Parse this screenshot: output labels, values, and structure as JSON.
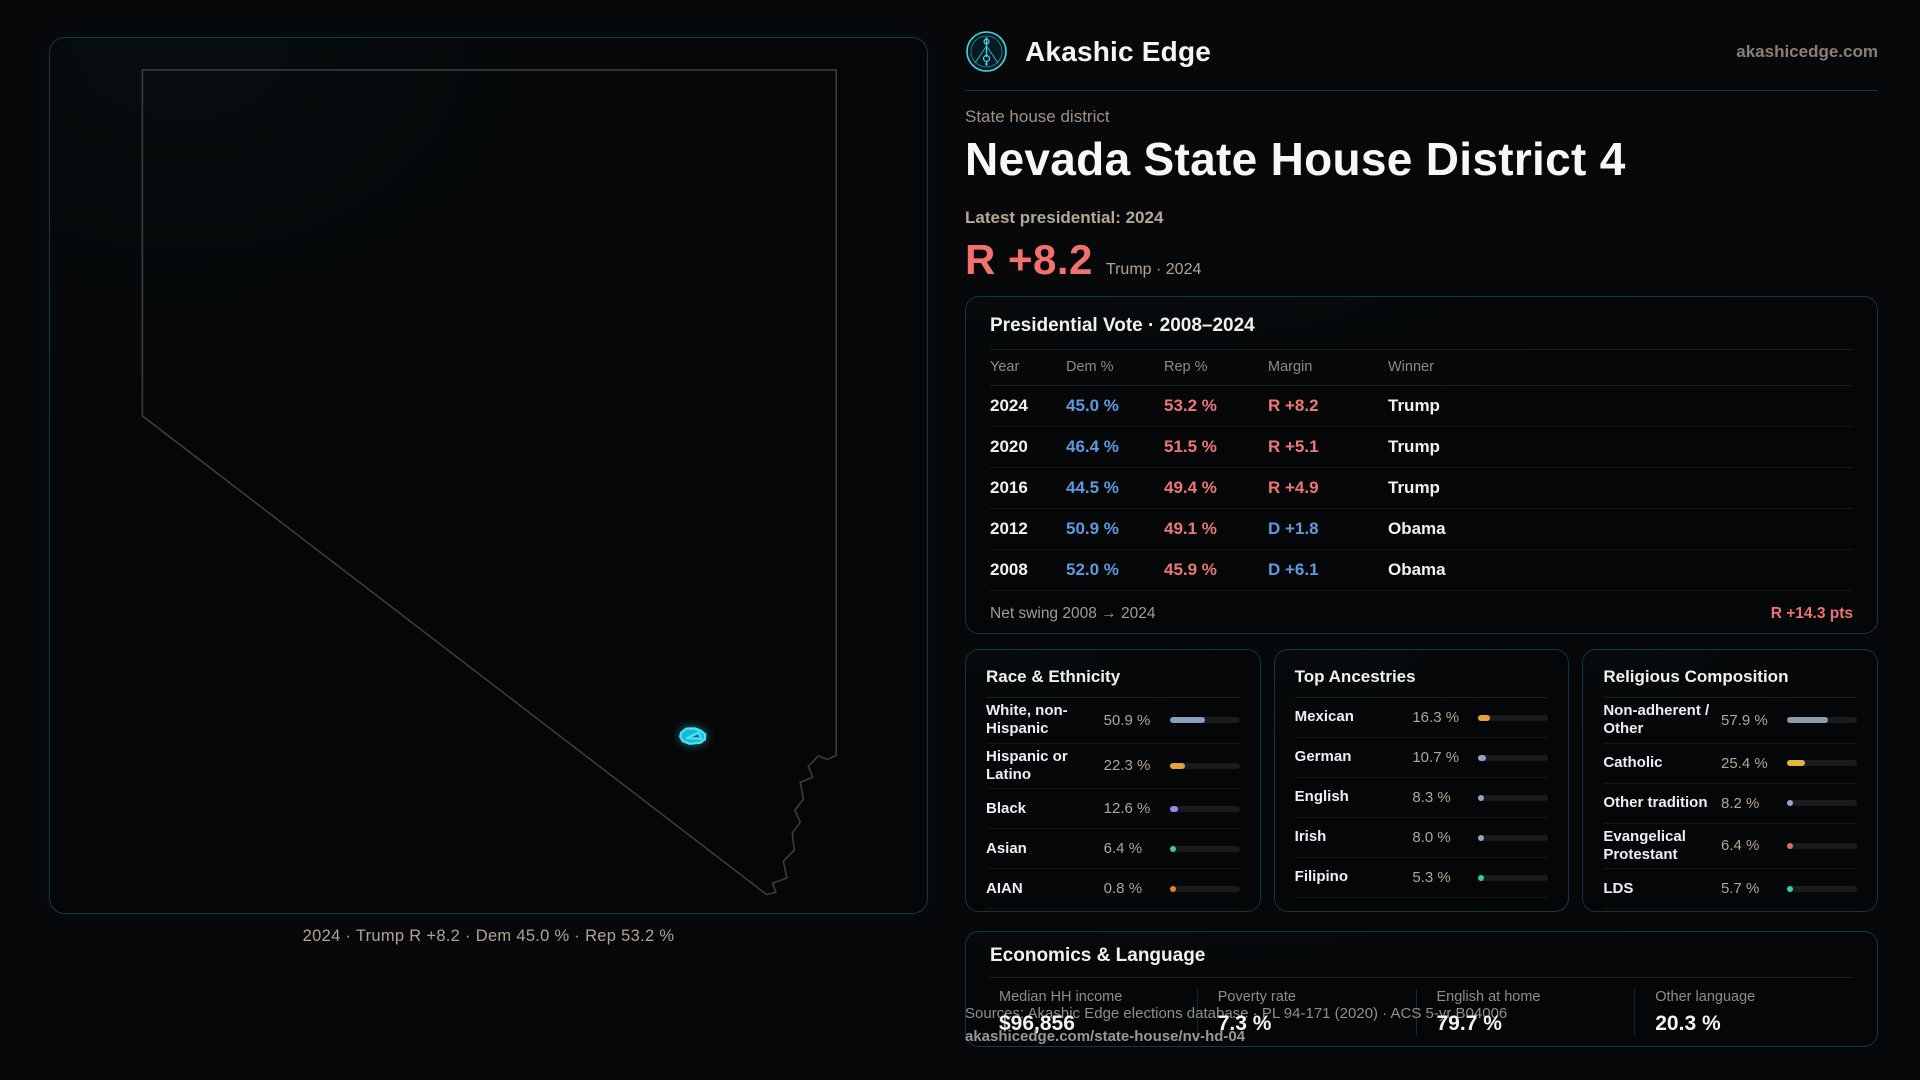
{
  "theme": {
    "accent_cyan": "#35d4e8",
    "dem_blue": "#5c9be0",
    "rep_red": "#ee7676",
    "metric_red": "#f2716f",
    "tan_text": "#b3a496"
  },
  "header": {
    "brand": "Akashic Edge",
    "domain": "akashicedge.com",
    "logo_icon": "akashic-edge-emblem"
  },
  "hero": {
    "eyebrow": "State house district",
    "title": "Nevada State House District 4",
    "latest_label": "Latest presidential: 2024",
    "metric": "R +8.2",
    "metric_note": "Trump · 2024"
  },
  "map": {
    "caption": "2024 · Trump R +8.2 · Dem 45.0 % · Rep 53.2 %",
    "highlight_color": "#35d4e8"
  },
  "presidential": {
    "title": "Presidential Vote · 2008–2024",
    "columns": [
      "Year",
      "Dem %",
      "Rep %",
      "Margin",
      "Winner"
    ],
    "rows": [
      {
        "year": "2024",
        "dem": "45.0 %",
        "rep": "53.2 %",
        "margin": "R +8.2",
        "party": "R",
        "winner": "Trump"
      },
      {
        "year": "2020",
        "dem": "46.4 %",
        "rep": "51.5 %",
        "margin": "R +5.1",
        "party": "R",
        "winner": "Trump"
      },
      {
        "year": "2016",
        "dem": "44.5 %",
        "rep": "49.4 %",
        "margin": "R +4.9",
        "party": "R",
        "winner": "Trump"
      },
      {
        "year": "2012",
        "dem": "50.9 %",
        "rep": "49.1 %",
        "margin": "D +1.8",
        "party": "D",
        "winner": "Obama"
      },
      {
        "year": "2008",
        "dem": "52.0 %",
        "rep": "45.9 %",
        "margin": "D +6.1",
        "party": "D",
        "winner": "Obama"
      }
    ],
    "net_swing_label": "Net swing 2008 → 2024",
    "net_swing_value": "R +14.3 pts"
  },
  "demographics": [
    {
      "title": "Race & Ethnicity",
      "rows": [
        {
          "label": "White, non-Hispanic",
          "value": "50.9 %",
          "pct": 50.9,
          "color": "#8b9cc0"
        },
        {
          "label": "Hispanic or Latino",
          "value": "22.3 %",
          "pct": 22.3,
          "color": "#e2a23b"
        },
        {
          "label": "Black",
          "value": "12.6 %",
          "pct": 12.6,
          "color": "#9b86ee"
        },
        {
          "label": "Asian",
          "value": "6.4 %",
          "pct": 6.4,
          "color": "#2fcf96"
        },
        {
          "label": "AIAN",
          "value": "0.8 %",
          "pct": 0.8,
          "color": "#e2832b"
        }
      ]
    },
    {
      "title": "Top Ancestries",
      "rows": [
        {
          "label": "Mexican",
          "value": "16.3 %",
          "pct": 16.3,
          "color": "#e2a23b"
        },
        {
          "label": "German",
          "value": "10.7 %",
          "pct": 10.7,
          "color": "#93a5c4"
        },
        {
          "label": "English",
          "value": "8.3 %",
          "pct": 8.3,
          "color": "#93a5c4"
        },
        {
          "label": "Irish",
          "value": "8.0 %",
          "pct": 8.0,
          "color": "#93a5c4"
        },
        {
          "label": "Filipino",
          "value": "5.3 %",
          "pct": 5.3,
          "color": "#2fcf96"
        }
      ]
    },
    {
      "title": "Religious Composition",
      "rows": [
        {
          "label": "Non-adherent / Other",
          "value": "57.9 %",
          "pct": 57.9,
          "color": "#8d99ad"
        },
        {
          "label": "Catholic",
          "value": "25.4 %",
          "pct": 25.4,
          "color": "#e3b63c"
        },
        {
          "label": "Other tradition",
          "value": "8.2 %",
          "pct": 8.2,
          "color": "#93a5c4"
        },
        {
          "label": "Evangelical Protestant",
          "value": "6.4 %",
          "pct": 6.4,
          "color": "#e06a6a"
        },
        {
          "label": "LDS",
          "value": "5.7 %",
          "pct": 5.7,
          "color": "#2fd0b0"
        }
      ]
    }
  ],
  "economics": {
    "title": "Economics & Language",
    "stats": [
      {
        "label": "Median HH income",
        "value": "$96,856"
      },
      {
        "label": "Poverty rate",
        "value": "7.3 %"
      },
      {
        "label": "English at home",
        "value": "79.7 %"
      },
      {
        "label": "Other language",
        "value": "20.3 %"
      }
    ]
  },
  "footer": {
    "sources": "Sources: Akashic Edge elections database · PL 94-171 (2020) · ACS 5-yr B04006",
    "permalink": "akashicedge.com/state-house/nv-hd-04"
  }
}
